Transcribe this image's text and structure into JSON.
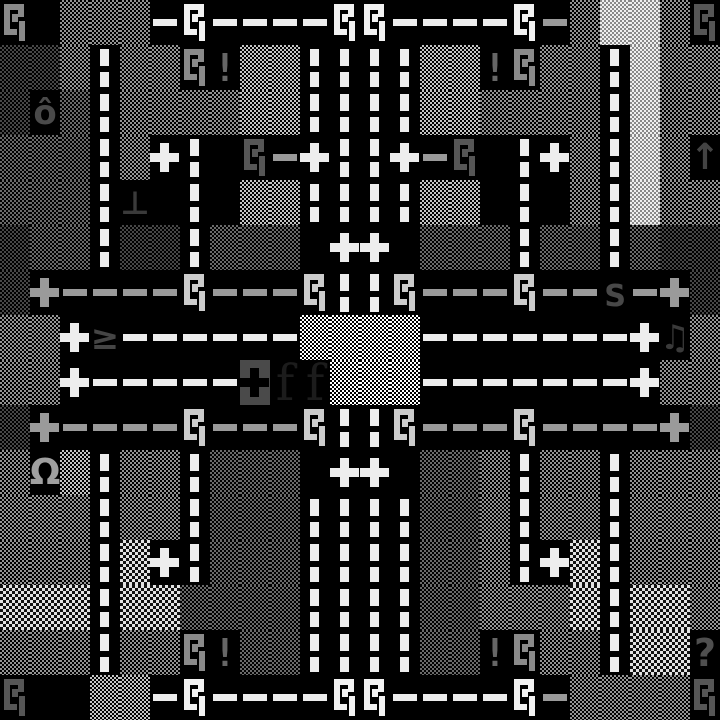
{
  "screen": {
    "kind": "roguelike-overmap",
    "description": "Monochrome tile map of roads with dashed lane lines crossing dithered fields, with map glyphs"
  },
  "colors": {
    "background": "#000000",
    "road_line_white": "#ededed",
    "road_line_gray": "#9a9a9a",
    "curve_bright": "#f2f2f2",
    "curve_light": "#cccccc",
    "curve_mid": "#8a8a8a",
    "curve_dark": "#565656"
  },
  "game_map": {
    "grid": {
      "cols": 24,
      "rows": 16,
      "cell_width": 30,
      "cell_height": 45
    },
    "legend": {
      "A": {
        "name": "field-checker-white",
        "type": "checker",
        "c1": "#ffffff",
        "c2": "#000000",
        "size": 4
      },
      "B": {
        "name": "field-checker-light",
        "type": "checker",
        "c1": "#c4c4c4",
        "c2": "#000000",
        "size": 4
      },
      "C": {
        "name": "field-checker-mid",
        "type": "checker",
        "c1": "#949494",
        "c2": "#000000",
        "size": 4
      },
      "D": {
        "name": "field-checker-dim",
        "type": "checker",
        "c1": "#6a6a6a",
        "c2": "#000000",
        "size": 4
      },
      "E": {
        "name": "field-checker-dark",
        "type": "checker",
        "c1": "#474747",
        "c2": "#000000",
        "size": 4
      },
      "W": {
        "name": "field-checker-pale",
        "type": "checker",
        "c1": "#f0f0f0",
        "c2": "#8a8a8a",
        "size": 4
      },
      "G": {
        "name": "field-checker-coarse",
        "type": "checker",
        "c1": "#e2e2e2",
        "c2": "#111111",
        "size": 6
      },
      "#": {
        "name": "road-blank",
        "type": "black",
        "bg": "#000000"
      },
      "|": {
        "name": "road-vertical",
        "type": "road-v",
        "color": "#ededed",
        "bg": "#000000"
      },
      "-": {
        "name": "road-horizontal",
        "type": "road-h",
        "color": "#ededed",
        "bg": "#000000"
      },
      "=": {
        "name": "road-horizontal-gray",
        "type": "road-h",
        "color": "#9a9a9a",
        "bg": "#000000"
      },
      "+": {
        "name": "road-intersection-icon",
        "type": "cross",
        "color": "#ededed",
        "bg": "#000000"
      },
      "x": {
        "name": "road-intersection-gray-icon",
        "type": "cross",
        "color": "#9a9a9a",
        "bg": "#000000"
      },
      "S": {
        "name": "road-curve-icon",
        "type": "spiral",
        "color": "#f2f2f2",
        "bg": "#000000"
      },
      "T": {
        "name": "road-curve-icon",
        "type": "spiral",
        "color": "#cccccc",
        "bg": "#000000"
      },
      "U": {
        "name": "road-curve-icon",
        "type": "spiral",
        "color": "#8a8a8a",
        "bg": "#000000"
      },
      "V": {
        "name": "road-curve-icon",
        "type": "spiral",
        "color": "#565656",
        "bg": "#000000"
      },
      "d": {
        "name": "crossing-block-icon",
        "type": "cross-block",
        "color": "#000000",
        "bg": "#4a4a4a"
      },
      "o": {
        "name": "glyph-o-circumflex",
        "type": "glyph",
        "char": "ô",
        "color": "#4a4a4a",
        "bg": "#000000",
        "font": "sans",
        "fs": 34,
        "bold": true
      },
      "L": {
        "name": "glyph-up-tack",
        "type": "glyph",
        "char": "⊥",
        "color": "#3a3a3a",
        "bg": "#000000",
        "font": "sans",
        "fs": 32,
        "bold": true
      },
      "g": {
        "name": "glyph-greater-equal",
        "type": "glyph",
        "char": "≥",
        "color": "#454545",
        "bg": "#000000",
        "font": "sans",
        "fs": 34,
        "bold": true
      },
      "m": {
        "name": "glyph-omega",
        "type": "glyph",
        "char": "Ω",
        "color": "#a0a0a0",
        "bg": "#000000",
        "font": "sans",
        "fs": 36,
        "bold": true
      },
      "f": {
        "name": "glyph-f-serif",
        "type": "glyph",
        "char": "f",
        "color": "#1c1c1c",
        "bg": "#000000",
        "font": "serif",
        "fs": 50,
        "bold": false
      },
      "n": {
        "name": "glyph-music-notes",
        "type": "glyph",
        "char": "♫",
        "color": "#3a3a3a",
        "bg": "#000000",
        "font": "sans",
        "fs": 34,
        "bold": false
      },
      "q": {
        "name": "glyph-question-mark",
        "type": "glyph",
        "char": "?",
        "color": "#4f4f4f",
        "bg": "#000000",
        "font": "sans",
        "fs": 38,
        "bold": true
      },
      "s": {
        "name": "glyph-s",
        "type": "glyph",
        "char": "s",
        "color": "#484848",
        "bg": "#000000",
        "font": "mono",
        "fs": 40,
        "bold": true
      },
      "a": {
        "name": "glyph-up-arrow",
        "type": "glyph",
        "char": "↑",
        "color": "#434343",
        "bg": "#000000",
        "font": "sans",
        "fs": 36,
        "bold": true
      },
      "!": {
        "name": "glyph-exclamation",
        "type": "glyph",
        "char": "!",
        "color": "#666666",
        "bg": "#000000",
        "font": "mono",
        "fs": 38,
        "bold": true
      }
    },
    "rows_data": [
      "U#CCC-S----SS----S=CWWCV",
      "EEC|CCU!BB||||BB!UCC|WCC",
      "EoD|CCCCBB||||BBCCCC|WCC",
      "DDD|C+|#V=+||+=V#|+C|WCa",
      "DDD|L#|#BB||||BB#|#C|WCC",
      "EDD|EE|DDD#++#DDD|DD|DEE",
      "Ex====T===T||T===T==s=xE",
      "CC+g------AAAA-------+nC",
      "CC+-----dffAAA-------+CC",
      "Ex====T===T||T===T====xE",
      "CmB|CC|DDD#++#DDC|CC|CCC",
      "CCC|CC|DDD||||DDC|CC|CCC",
      "CCC|G+|DDD||||DDC|+G|CCC",
      "GGG|GGDDDD||||DDCCCG|GGC",
      "CCC|CCU!DD||||DD!UCC|GGq",
      "V##BB-S----SS----S=CCCCV"
    ]
  }
}
